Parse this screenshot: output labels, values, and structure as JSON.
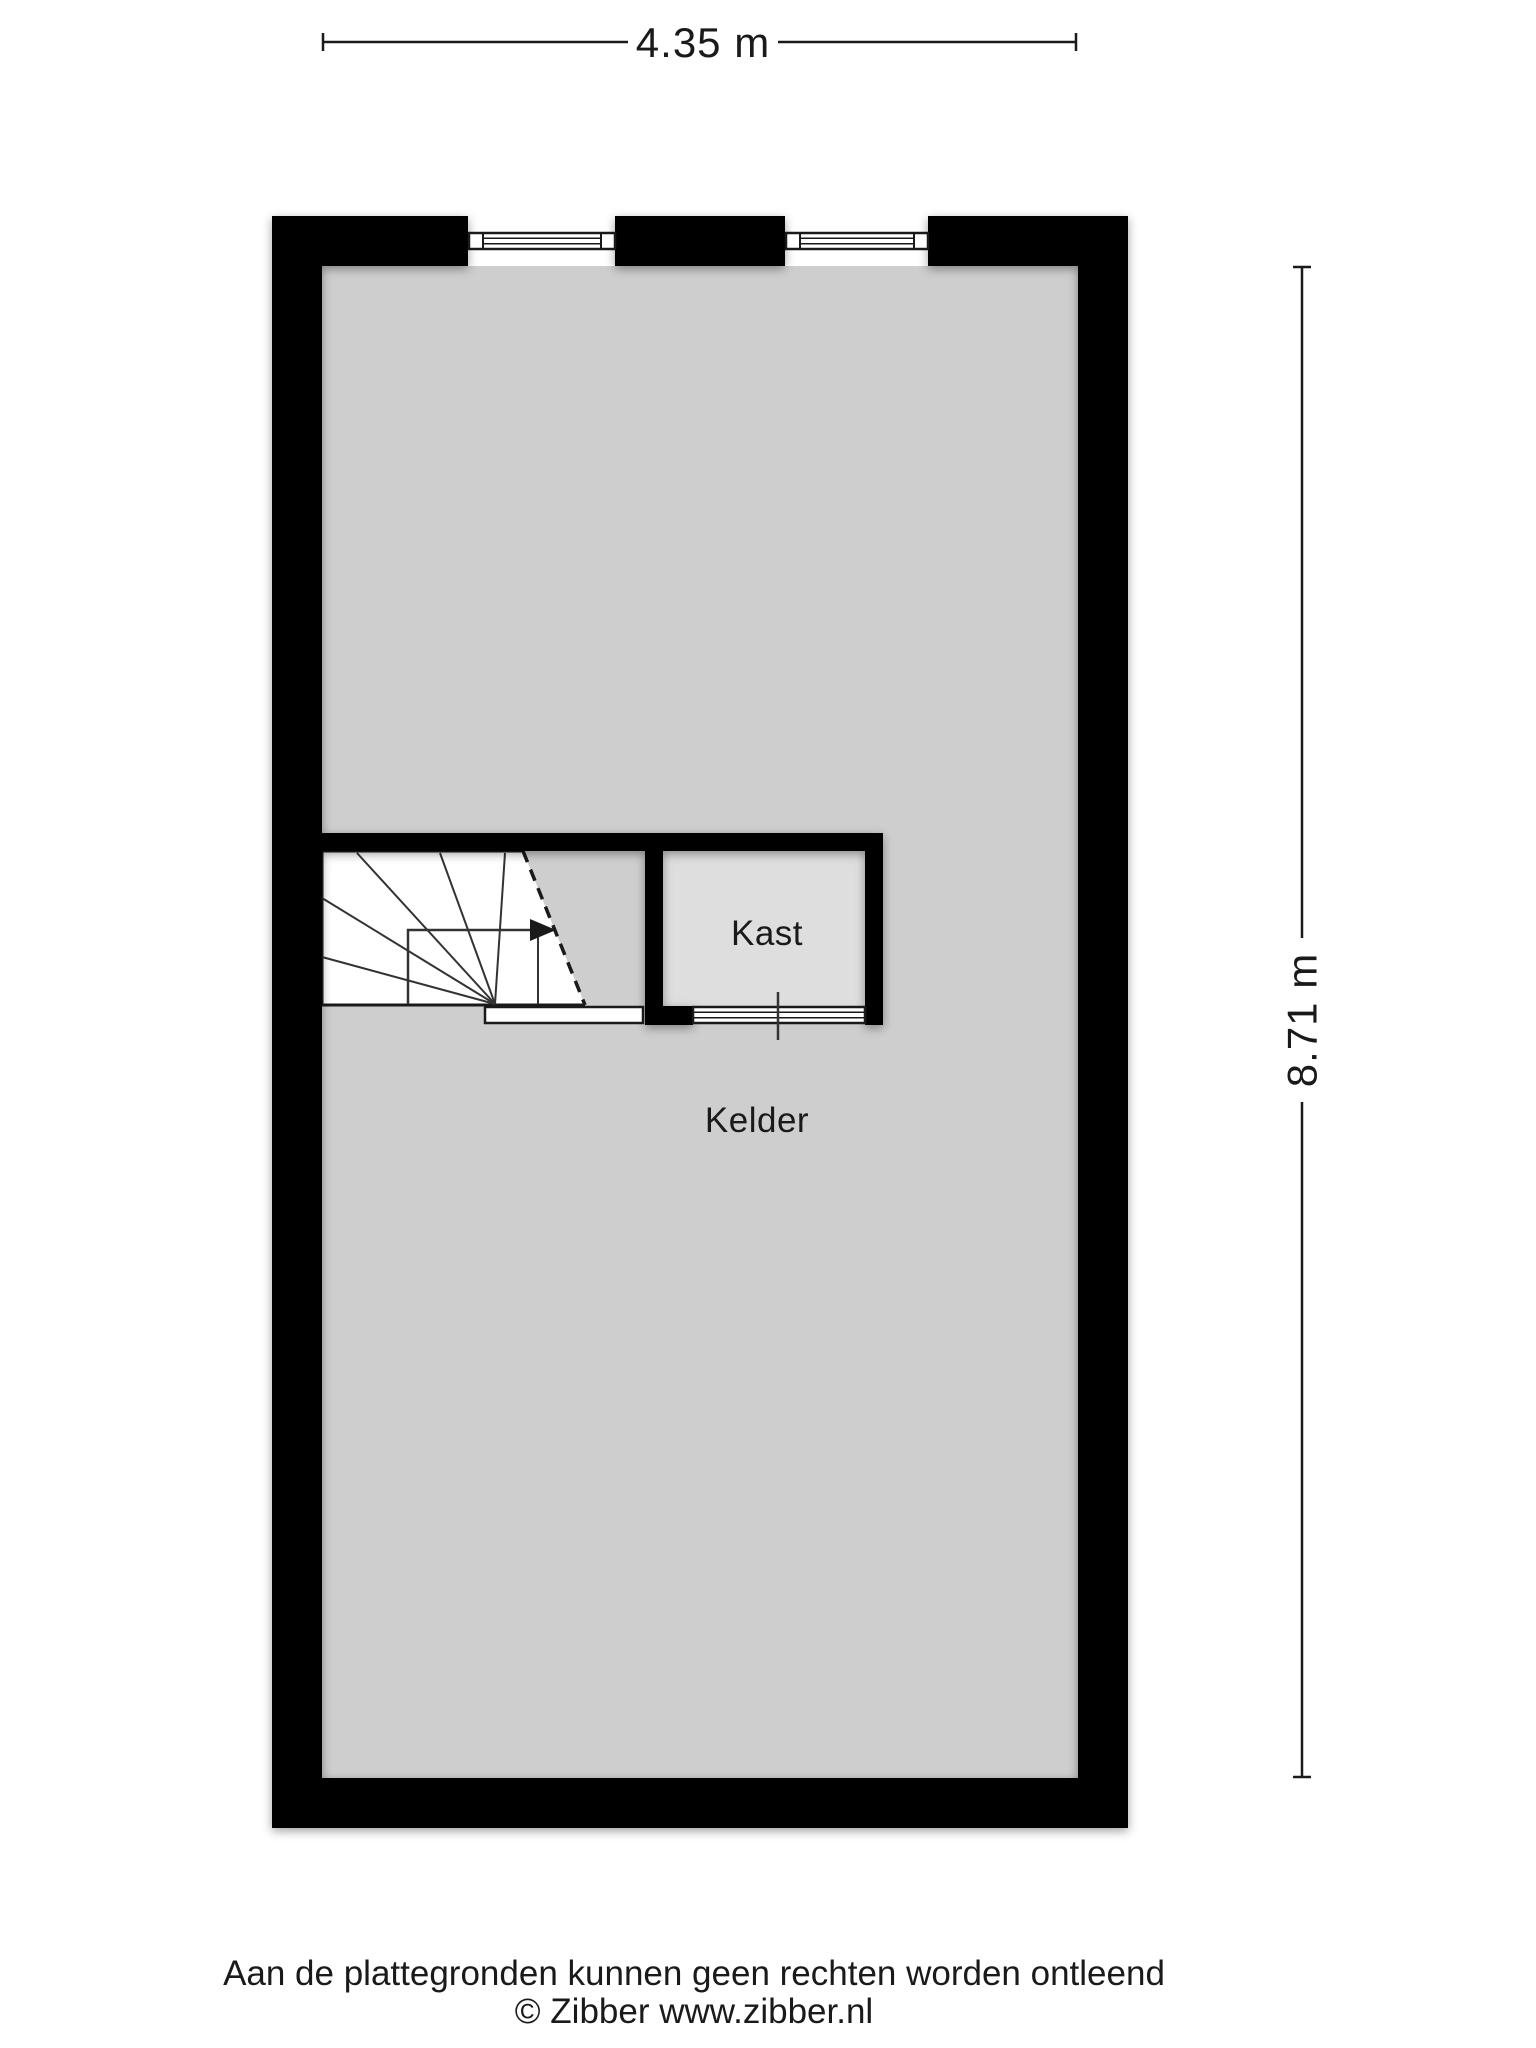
{
  "plan": {
    "dimensions": {
      "top_label": "4.35 m",
      "right_label": "8.71 m"
    },
    "rooms": {
      "kelder": {
        "label": "Kelder"
      },
      "kast": {
        "label": "Kast"
      }
    },
    "colors": {
      "background": "#ffffff",
      "wall": "#000000",
      "floor": "#cecece",
      "kast_floor": "#dedede",
      "stairs": "#ffffff",
      "line": "#1a1a1a"
    },
    "footer": {
      "line1": "Aan de plattegronden kunnen geen rechten worden ontleend",
      "line2": "© Zibber www.zibber.nl"
    }
  }
}
